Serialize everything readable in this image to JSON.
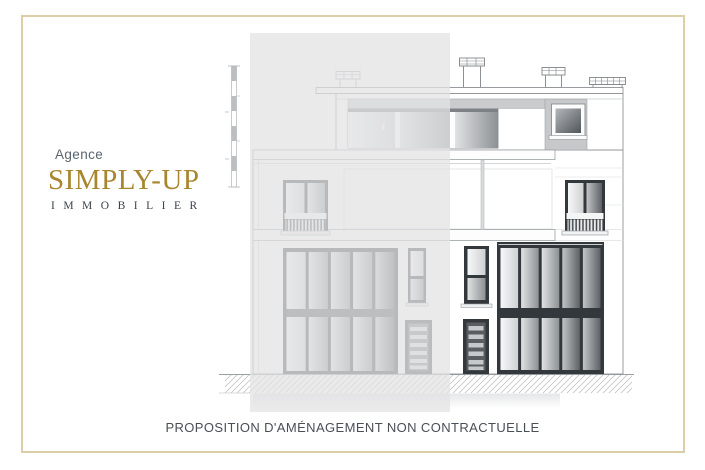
{
  "page": {
    "background_color": "#ffffff",
    "border_color": "#dccfa8"
  },
  "logo": {
    "agence": "Agence",
    "brand": "SIMPLY-UP",
    "subtitle": "IMMOBILIER",
    "brand_color": "#a8862f",
    "agence_color": "#5a646e",
    "subtitle_color": "#3a424c"
  },
  "caption": {
    "text": "PROPOSITION D'AMÉNAGEMENT NON CONTRACTUELLE",
    "color": "#494f56"
  },
  "drawing": {
    "type": "architectural elevation",
    "subject": "three-storey townhouse street facade",
    "left_half": "faded (existing state) under translucent overlay",
    "right_half": "full-contrast proposed design",
    "line_color": "#8e9296",
    "window_frame_color": "#33383c",
    "ground_style": "diagonal hatching",
    "features": [
      "height-scale-bar",
      "chimneys",
      "roof-terrace-glazing",
      "dormer-window",
      "french-balcony-windows",
      "storefront-glazing",
      "louvered-doors"
    ]
  }
}
